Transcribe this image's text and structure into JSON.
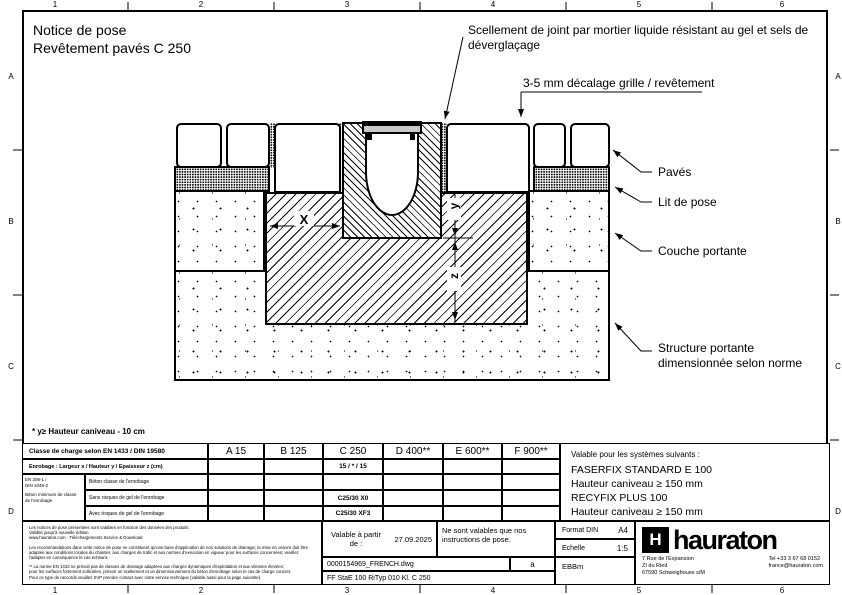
{
  "sheet": {
    "cols": [
      "1",
      "2",
      "3",
      "4",
      "5",
      "6"
    ],
    "rows": [
      "A",
      "B",
      "C",
      "D"
    ]
  },
  "colors": {
    "ink": "#000000",
    "paper": "#ffffff",
    "grate": "#c9c9c9"
  },
  "title": {
    "line1": "Notice de pose",
    "line2": "Revêtement pavés C 250"
  },
  "callouts": {
    "sealant": "Scellement de joint par mortier liquide résistant au gel et sels de déverglaçage",
    "offset": "3-5 mm décalage grille / revêtement",
    "paves": "Pavés",
    "bedding": "Lit de pose",
    "base": "Couche portante",
    "structure1": "Structure portante",
    "structure2": "dimensionnée selon norme"
  },
  "dims": {
    "x": "X",
    "y": "y",
    "z": "z"
  },
  "footnote": "* y≥ Hauteur caniveau - 10 cm",
  "load_table": {
    "class_row_label": "Classe de charge selon EN 1433 / DIN 19580",
    "classes": [
      "A 15",
      "B 125",
      "C 250",
      "D 400**",
      "E 600**",
      "F 900**"
    ],
    "dims_row_label": "Enrobage : Largeur x / Hauteur y / Epaisseur z (cm)",
    "dims_c250": "15 / * / 15",
    "standard_lines": [
      "EN 206-1 /",
      "DIN 1045-2",
      "Béton minimum de classe",
      "de l'enrobage"
    ],
    "concrete_rows": [
      {
        "label": "Béton classe de l'enrobage",
        "c250": ""
      },
      {
        "label": "Sans risques de gel de l'enrobage",
        "c250": "C25/30 X0"
      },
      {
        "label": "Avec risques de gel de l'enrobage",
        "c250": "C25/30 XF3"
      }
    ]
  },
  "systems": {
    "heading": "Valable pour les systèmes suivants :",
    "lines": [
      "FASERFIX STANDARD E 100",
      "Hauteur caniveau ≥ 150 mm",
      "RECYFIX PLUS 100",
      "Hauteur caniveau ≥ 150 mm"
    ]
  },
  "title_block": {
    "fine_print_p1": [
      "Les notices de pose présentées sont valables en fonction des données des produits",
      "Validité jusqu'à nouvelle édition",
      "www.hauraton.com - Téléchargements Service & Download"
    ],
    "fine_print_p2": [
      "Les recommandations dans cette notice de pose ne constituent qu'une base d'application de nos solutions de drainage; la mise en oeuvre doit être",
      "adaptée aux conditions locales du chantier, aux charges de trafic et aux normes d'exécution en vigueur pour les surfaces concernées; veuillez",
      "l'adapter en conséquence le cas échéant."
    ],
    "fine_print_p3": [
      "** La norme EN 1433 ne prévoit pas de classes de drainage adaptées aux charges dynamiques d'exploitation et aux vitesses élevées;",
      "pour les surfaces fortement sollicitées, prévoir un scellement et un dimensionnement du béton d'enrobage selon le cas de charge concret.",
      "Pour ce type de raccords veuillez SVP prendre contact avec notre service technique (valable aussi pour la page suivante)."
    ],
    "valid_from_label": "Valable à partir de :",
    "valid_from_date": "27.09.2025",
    "note": "Ne sont valables que nos instructions de pose.",
    "filename": "0000154969_FRENCH.dwg",
    "revision": "a",
    "drawing_code": "FF  StaE 100 RiTyp 010 Kl. C 250",
    "format_label": "Format DIN",
    "format_value": "A4",
    "scale_label": "Echelle",
    "scale_value": "1:5",
    "author": "EBBm",
    "brand_initial": "H",
    "brand_name": "hauraton",
    "address": [
      "7 Rue de l'Expansion",
      "ZI du Ried",
      "67590 Schweighouse s/M"
    ],
    "contact": [
      "Tel +33 3 67 68 0152",
      "france@hauraton.com"
    ]
  }
}
